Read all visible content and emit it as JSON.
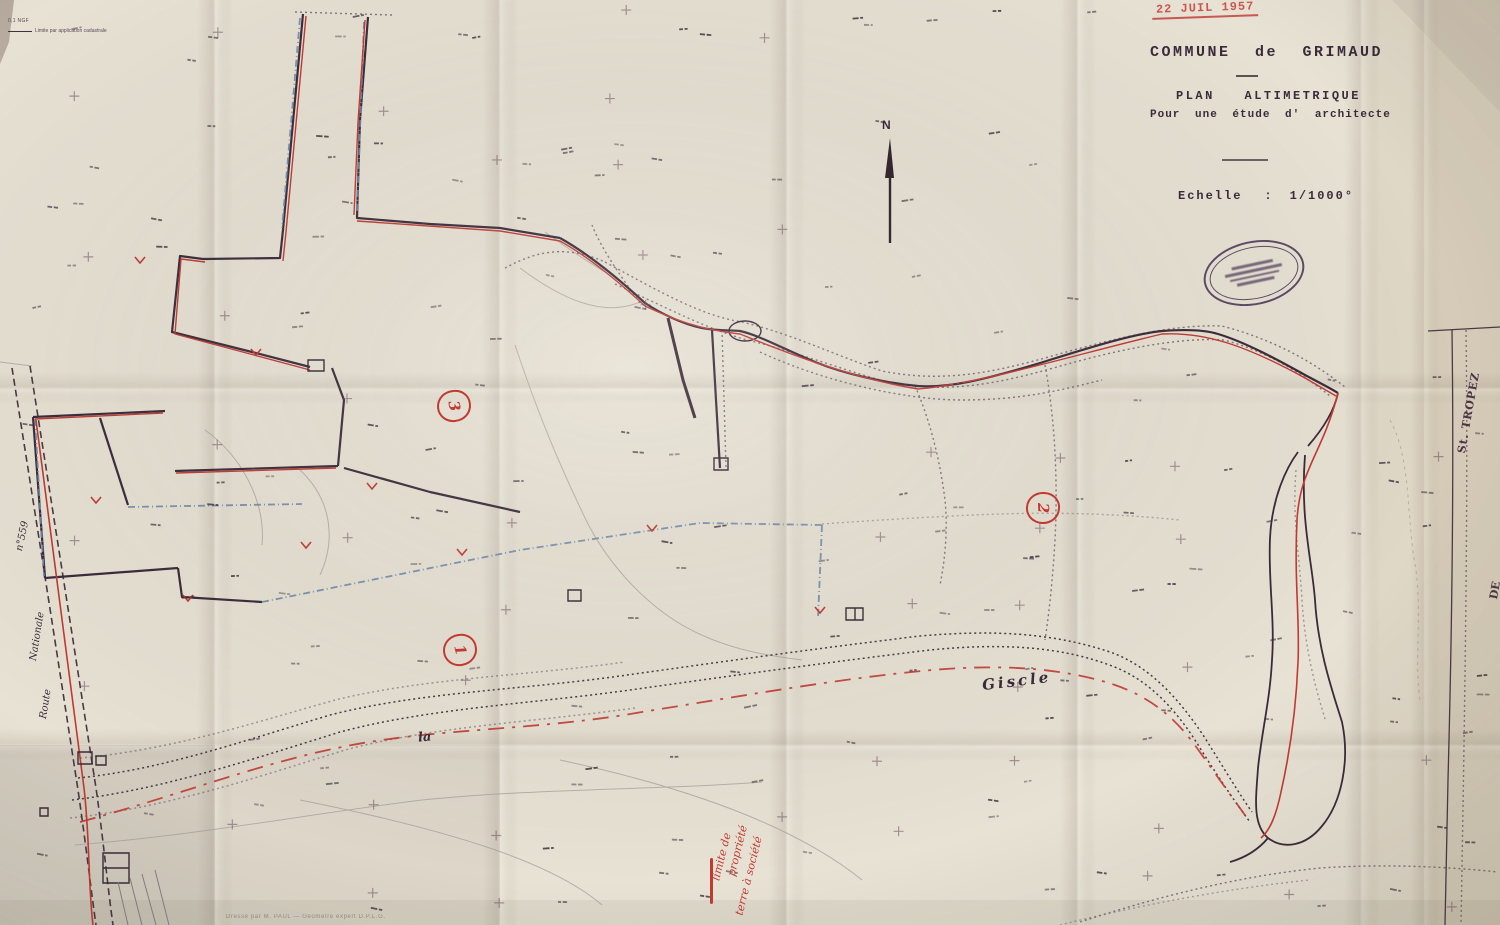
{
  "sheet": {
    "title_line1": "COMMUNE de GRIMAUD",
    "title_line2": "PLAN ALTIMETRIQUE",
    "title_line3": "Pour une étude d' architecte",
    "scale_label": "Echelle",
    "scale_separator": ":",
    "scale_value": "1/1000°"
  },
  "stamps": {
    "date_received": "22 JUIL 1957"
  },
  "compass": {
    "north_label": "N"
  },
  "labels": {
    "road_number": "n°559",
    "road_name_upper": "Nationale",
    "road_name_lower": "Route",
    "river_article": "la",
    "river_name": "Giscle",
    "right_edge_de": "DE",
    "right_edge_st_tropez": "St. TROPEZ",
    "parcel_numbers": [
      "1",
      "2",
      "3"
    ]
  },
  "annotations": {
    "red_note_line1": "limite de",
    "red_note_line2": "propriété",
    "red_note_line3": "terre à société",
    "corner_note_line1": "0,1 NGF",
    "corner_note_line2": "Limite par application cadastrale",
    "bottom_caption": "Dressé par M. PAUL — Géomètre expert D.P.L.G."
  },
  "colors": {
    "paper": "#e8e2d4",
    "ink": "#42303f",
    "red": "#c13a32",
    "blue": "#6e89ac"
  }
}
